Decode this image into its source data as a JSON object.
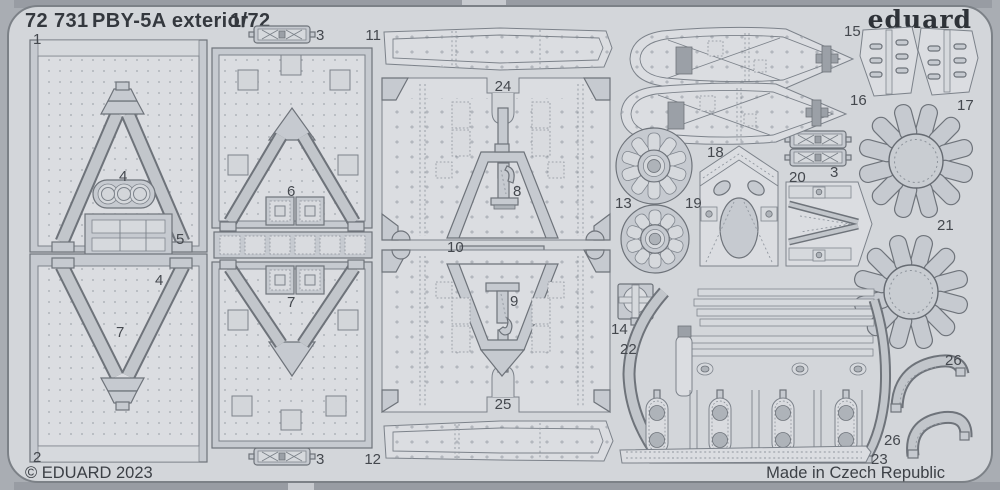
{
  "header": {
    "code": "72 731",
    "title": "PBY-5A exterior",
    "scale": "1/72"
  },
  "brand": {
    "name": "eduard"
  },
  "footer": {
    "copyright": "© EDUARD 2023",
    "made_in": "Made in Czech Republic"
  },
  "colors": {
    "background": "#a9adb3",
    "sheet": "#d3d6da",
    "part": "#c6cad0",
    "part_light": "#dbdde1",
    "part_dark": "#9ba0a7",
    "outline": "#6e737a",
    "text": "#34383e",
    "label": "#44484e"
  },
  "sheet": {
    "description": "photo-etched fret with numbered parts",
    "part_labels": [
      {
        "n": "1",
        "x": 33,
        "y": 44,
        "a": "start"
      },
      {
        "n": "3",
        "x": 316,
        "y": 40,
        "a": "start"
      },
      {
        "n": "11",
        "x": 381,
        "y": 40,
        "a": "end"
      },
      {
        "n": "15",
        "x": 844,
        "y": 36,
        "a": "start"
      },
      {
        "n": "24",
        "x": 503,
        "y": 91,
        "a": "middle"
      },
      {
        "n": "16",
        "x": 850,
        "y": 105,
        "a": "start"
      },
      {
        "n": "17",
        "x": 957,
        "y": 110,
        "a": "start"
      },
      {
        "n": "4",
        "x": 119,
        "y": 181,
        "a": "start"
      },
      {
        "n": "13",
        "x": 615,
        "y": 208,
        "a": "start"
      },
      {
        "n": "18",
        "x": 707,
        "y": 157,
        "a": "start"
      },
      {
        "n": "19",
        "x": 685,
        "y": 208,
        "a": "start"
      },
      {
        "n": "20",
        "x": 789,
        "y": 182,
        "a": "start"
      },
      {
        "n": "3",
        "x": 830,
        "y": 177,
        "a": "start"
      },
      {
        "n": "21",
        "x": 937,
        "y": 230,
        "a": "start"
      },
      {
        "n": "5",
        "x": 176,
        "y": 244,
        "a": "start"
      },
      {
        "n": "6",
        "x": 287,
        "y": 196,
        "a": "start"
      },
      {
        "n": "8",
        "x": 513,
        "y": 196,
        "a": "start"
      },
      {
        "n": "10",
        "x": 447,
        "y": 252,
        "a": "start"
      },
      {
        "n": "4",
        "x": 155,
        "y": 285,
        "a": "start"
      },
      {
        "n": "7",
        "x": 116,
        "y": 337,
        "a": "start"
      },
      {
        "n": "9",
        "x": 510,
        "y": 306,
        "a": "start"
      },
      {
        "n": "14",
        "x": 611,
        "y": 334,
        "a": "start"
      },
      {
        "n": "22",
        "x": 620,
        "y": 354,
        "a": "start"
      },
      {
        "n": "7",
        "x": 287,
        "y": 307,
        "a": "start"
      },
      {
        "n": "25",
        "x": 503,
        "y": 409,
        "a": "middle"
      },
      {
        "n": "26",
        "x": 945,
        "y": 365,
        "a": "start"
      },
      {
        "n": "2",
        "x": 33,
        "y": 462,
        "a": "start"
      },
      {
        "n": "3",
        "x": 316,
        "y": 464,
        "a": "start"
      },
      {
        "n": "12",
        "x": 381,
        "y": 464,
        "a": "end"
      },
      {
        "n": "26",
        "x": 884,
        "y": 445,
        "a": "start"
      },
      {
        "n": "23",
        "x": 871,
        "y": 464,
        "a": "start"
      }
    ]
  }
}
